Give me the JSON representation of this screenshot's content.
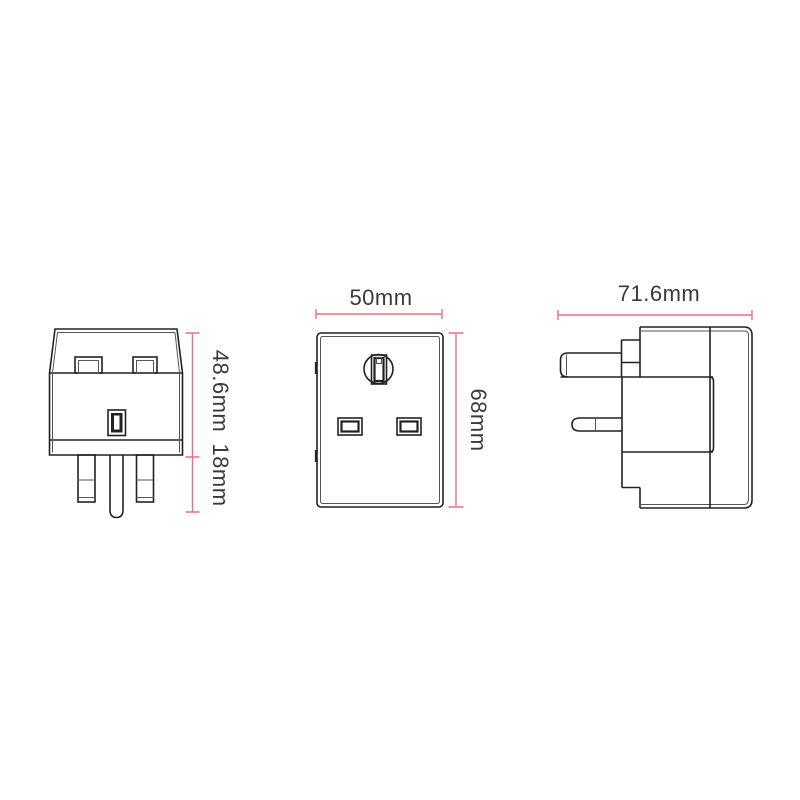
{
  "colors": {
    "art": "#222222",
    "art_soft": "#555555",
    "dim": "#ed6f7f",
    "label": "#3a3a3a",
    "background": "#ffffff"
  },
  "dimensions": {
    "top_view_body_height": "48.6mm",
    "top_view_pin_length": "18mm",
    "front_view_width": "50mm",
    "front_view_height": "68mm",
    "side_view_depth": "71.6mm"
  }
}
